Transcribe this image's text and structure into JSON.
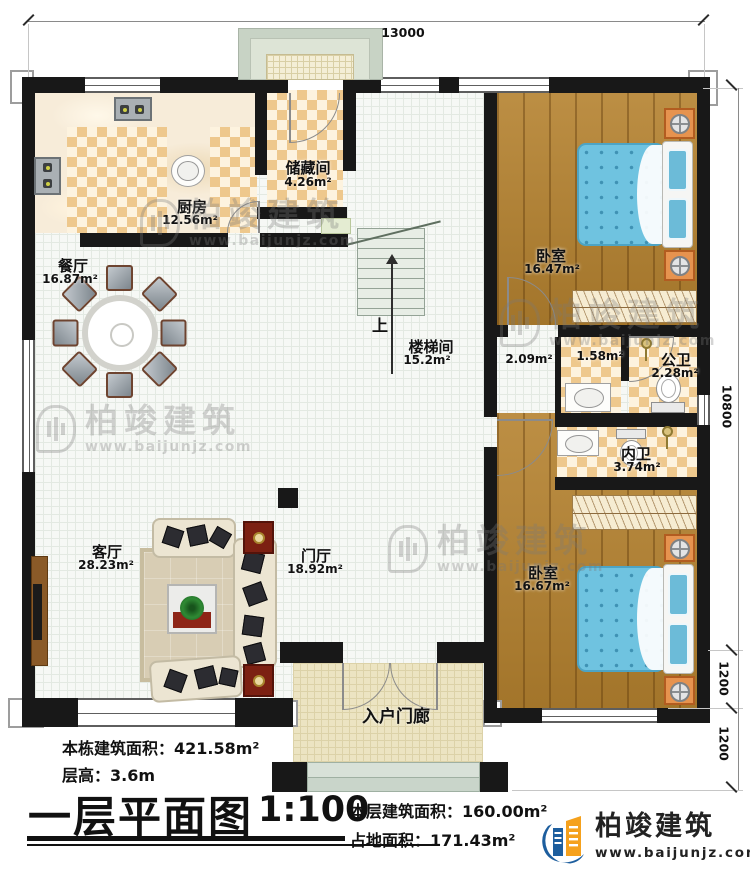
{
  "plan": {
    "dimensions": {
      "top_width": "13000",
      "right_height_main": "10800",
      "right_porch_depth": "1200",
      "right_steps_depth": "1200"
    },
    "rooms": {
      "kitchen": {
        "name": "厨房",
        "area": "12.56m²"
      },
      "storage": {
        "name": "储藏间",
        "area": "4.26m²"
      },
      "dining": {
        "name": "餐厅",
        "area": "16.87m²"
      },
      "bedroom_top": {
        "name": "卧室",
        "area": "16.47m²"
      },
      "stairwell": {
        "name": "楼梯间",
        "area": "15.2m²"
      },
      "corridor": {
        "area": "2.09m²"
      },
      "inner_hall": {
        "area": "1.58m²"
      },
      "public_bath": {
        "name": "公卫",
        "area": "2.28m²"
      },
      "ensuite_bath": {
        "name": "内卫",
        "area": "3.74m²"
      },
      "living": {
        "name": "客厅",
        "area": "28.23m²"
      },
      "foyer": {
        "name": "门厅",
        "area": "18.92m²"
      },
      "bedroom_bottom": {
        "name": "卧室",
        "area": "16.67m²"
      },
      "entry_porch": {
        "name": "入户门廊"
      }
    },
    "stairs": {
      "up_label": "上"
    }
  },
  "footer": {
    "total_building_area": "本栋建筑面积：421.58m²",
    "floor_height": "层高：3.6m",
    "title": "一层平面图",
    "scale": "1:100",
    "floor_area": "本层建筑面积：160.00m²",
    "footprint_area": "占地面积：171.43m²"
  },
  "branding": {
    "watermark": {
      "brand": "柏竣建筑",
      "url": "www.baijunjz.com"
    },
    "logo": {
      "brand": "柏竣建筑",
      "url": "www.baijunjz.com"
    }
  },
  "colors": {
    "wall": "#181818",
    "checker_tan": "#eec88d",
    "wood_floor": "#b5822f",
    "bed_blue": "#6fc3e0",
    "nightstand_orange": "#e6934f",
    "logo_blue": "#1d5e9e",
    "logo_orange": "#f5a11d"
  }
}
